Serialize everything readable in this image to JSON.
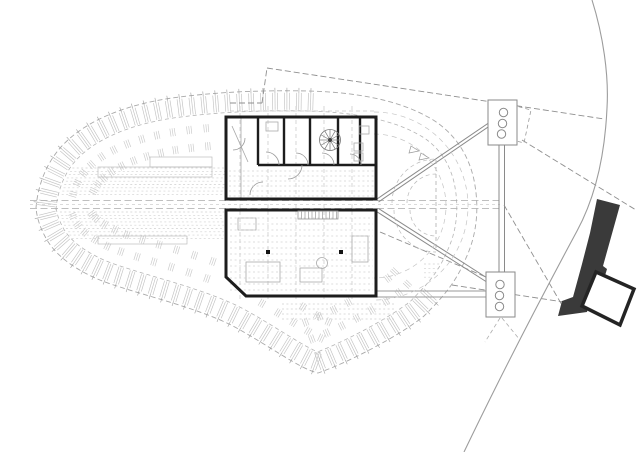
{
  "meta": {
    "kind": "architectural-site-plan",
    "visible_text": [],
    "background": "#ffffff"
  },
  "colors": {
    "faint": "#d0d0d0",
    "texture": "#c2c2c2",
    "light": "#b5b5b5",
    "boundary": "#a9a9a9",
    "medium": "#8f8f8f",
    "bridge": "#8a8a8a",
    "bold": "#1d1d1d",
    "dark_fill": "#3a3a3a",
    "platform_stroke": "#242424",
    "white": "#ffffff",
    "column": "#141414"
  },
  "stadium": {
    "outer": "M36,208 C38,183 48,158 68,140 C92,118 130,104 172,98 C215,92 262,90 308,91 C352,92 396,99 428,117 C452,130 468,152 474,180 C479,205 478,232 466,258 C456,282 444,296 424,316 C402,334 350,362 318,373 C300,369 268,345 233,326 C200,309 150,297 117,286 C90,278 60,262 47,240 C40,228 37,218 36,208 Z",
    "centroid": [
      258,
      230
    ],
    "inner_offset": 20,
    "rib_step": 12,
    "cluster_offsets": [
      34,
      52
    ],
    "cluster_step": 18,
    "strips": [
      {
        "y0": 168,
        "y1": 197,
        "step": 3.3,
        "side": "L",
        "xEnd": 226
      },
      {
        "y0": 212,
        "y1": 241,
        "step": 3.3,
        "side": "L",
        "xEnd": 224
      },
      {
        "y0": 222,
        "y1": 239,
        "step": 3.4,
        "side": "R",
        "xStart": 448
      },
      {
        "y0": 264,
        "y1": 289,
        "step": 4.4,
        "side": "R",
        "xStart": 424
      },
      {
        "y0": 304,
        "y1": 322,
        "step": 5,
        "side": "F",
        "xStart": 282,
        "xEnd": 396
      }
    ],
    "rings": [
      "M374,112 A94,94 0 0 1 468,206 A94,94 0 0 1 374,300",
      "M374,134 A72,72 0 0 1 446,206 A72,72 0 0 1 374,278"
    ]
  },
  "line_groups": [
    {
      "name": "grid-line",
      "color": "#c6c6c6",
      "w": 0.7,
      "dash": "4 3",
      "lines": [
        [
          240,
          106,
          240,
          302
        ],
        [
          268,
          106,
          268,
          302
        ],
        [
          296,
          106,
          296,
          302
        ],
        [
          324,
          106,
          324,
          302
        ],
        [
          352,
          106,
          352,
          302
        ],
        [
          230,
          111,
          375,
          111
        ]
      ]
    },
    {
      "name": "corridor-line",
      "color": "#ababab",
      "w": 0.8,
      "dash": "7 3.5",
      "lines": [
        [
          30,
          200.5,
          376,
          200.5
        ],
        [
          30,
          208.5,
          376,
          208.5
        ],
        [
          377,
          200.5,
          500,
          200.5
        ],
        [
          377,
          208.5,
          500,
          208.5
        ]
      ]
    },
    {
      "name": "corridor-centerline",
      "color": "#cfcfcf",
      "w": 0.7,
      "dash": "3 3",
      "lines": [
        [
          30,
          204.5,
          500,
          204.5
        ]
      ]
    },
    {
      "name": "walkway-line",
      "color": "#9a9a9a",
      "w": 0.9,
      "dash": "",
      "lines": [
        [
          377,
          291,
          487,
          291
        ],
        [
          377,
          297,
          487,
          297
        ]
      ]
    },
    {
      "name": "bridge-line",
      "color": "#8a8a8a",
      "w": 1,
      "dash": "",
      "lines": [
        [
          377,
          199,
          490,
          122
        ],
        [
          378.5,
          202,
          491,
          125
        ],
        [
          376.5,
          211.5,
          487.5,
          282.5
        ],
        [
          378.5,
          208.5,
          489.5,
          279.5
        ],
        [
          499,
          145,
          499,
          272
        ],
        [
          504.5,
          145,
          504.5,
          272
        ]
      ]
    },
    {
      "name": "setback-dashed-line",
      "color": "#8f8f8f",
      "w": 0.9,
      "dash": "6 3",
      "lines": [
        [
          230,
          103,
          262,
          103
        ],
        [
          262,
          103,
          267,
          68
        ],
        [
          267,
          68,
          604,
          119
        ],
        [
          522,
          140,
          636,
          210
        ],
        [
          452,
          285,
          583,
          305
        ],
        [
          504,
          205,
          566,
          312
        ],
        [
          380,
          232,
          486,
          277
        ]
      ]
    },
    {
      "name": "tower-ray",
      "color": "#adadad",
      "w": 0.8,
      "dash": "4 3",
      "lines": [
        [
          500,
          318,
          485,
          342
        ],
        [
          502,
          318,
          520,
          340
        ],
        [
          436,
          160,
          436,
          250
        ]
      ]
    },
    {
      "name": "interior-wall",
      "color": "#1d1d1d",
      "w": 2.4,
      "dash": "",
      "lines": [
        [
          258,
          118,
          258,
          165
        ],
        [
          284,
          118,
          284,
          165
        ],
        [
          310,
          118,
          310,
          165
        ],
        [
          338,
          118,
          338,
          165
        ],
        [
          360,
          118,
          360,
          165
        ],
        [
          258,
          165,
          376,
          165
        ]
      ]
    },
    {
      "name": "interior-light-line",
      "color": "#a8a8a8",
      "w": 0.8,
      "dash": "",
      "lines": [
        [
          241,
          118,
          241,
          198
        ],
        [
          232,
          126,
          248,
          162
        ]
      ]
    }
  ],
  "path_groups": [
    {
      "name": "stadium-ring-arc",
      "color": "#c4c4c4",
      "w": 0.7,
      "dash": "5 4",
      "fill": "none",
      "paths": [
        "M374,112 A94,94 0 0 1 468,206 A94,94 0 0 1 374,300",
        "M374,134 A72,72 0 0 1 446,206 A72,72 0 0 1 374,278"
      ]
    },
    {
      "name": "concourse-arc",
      "color": "#b9b9b9",
      "w": 0.7,
      "dash": "4 3",
      "fill": "none",
      "paths": [
        "M392,203 A44,44 0 0 1 436,159",
        "M407,203 A29,29 0 0 1 436,174",
        "M394,210 A42,42 0 0 0 436,252",
        "M410,210 A26,26 0 0 0 436,236"
      ]
    },
    {
      "name": "marker-triangle",
      "color": "#999999",
      "w": 0.7,
      "dash": "",
      "fill": "none",
      "paths": [
        "M411,146 L419,151 L409,153 Z",
        "M421,153 L429,158 L419,160 Z"
      ]
    },
    {
      "name": "tower-link-quad",
      "color": "#9a9a9a",
      "w": 0.8,
      "dash": "4 3",
      "fill": "none",
      "paths": [
        "M505,103 L531,110 L524,143 L498,136 Z"
      ]
    },
    {
      "name": "door-arc",
      "color": "#999999",
      "w": 0.8,
      "dash": "",
      "fill": "none",
      "paths": [
        "M266,152 A13,13 0 0 1 279,165",
        "M296,153 A12,12 0 0 1 308,165",
        "M322,153 A12,12 0 0 1 334,165",
        "M350,154 A11,11 0 0 1 361,165",
        "M288,179 A14,14 0 0 0 302,165",
        "M250,195 A13,13 0 0 1 263,182",
        "M233,150 A12,12 0 0 0 245,138"
      ]
    }
  ],
  "rect_groups": [
    {
      "name": "stand-rect",
      "color": "#bdbdbd",
      "w": 0.7,
      "rects": [
        [
          150,
          157,
          62,
          10
        ],
        [
          98,
          167,
          114,
          10
        ],
        [
          98,
          236,
          89,
          8
        ]
      ]
    },
    {
      "name": "furniture-rect",
      "color": "#ababab",
      "w": 0.8,
      "rects": [
        [
          246,
          262,
          34,
          20
        ],
        [
          300,
          268,
          22,
          14
        ],
        [
          352,
          236,
          16,
          26
        ],
        [
          266,
          122,
          12,
          9
        ],
        [
          359,
          126,
          10,
          8
        ],
        [
          354,
          143,
          9,
          8
        ],
        [
          354,
          153,
          9,
          8
        ],
        [
          238,
          218,
          18,
          12
        ]
      ]
    }
  ],
  "block_rows": [
    {
      "y0": 171,
      "y1": 196,
      "step": 5,
      "x0": 229,
      "x1": 374
    },
    {
      "y0": 218,
      "y1": 290,
      "step": 6,
      "x0": 230,
      "x1": 373
    }
  ],
  "buildings": {
    "upper_outline": "M226,117 H376 V199 H226 Z",
    "lower_outline": "M226,210 H376 V296 H246 L226,277 Z"
  },
  "stair_hatch": {
    "x": 298,
    "y": 211,
    "w": 40,
    "h": 8,
    "rung_step": 3.5,
    "color": "#9a9a9a"
  },
  "spiral_stair": {
    "cx": 330,
    "cy": 140,
    "r": 10.5,
    "spokes": 12,
    "color": "#777777"
  },
  "columns": {
    "size": 4,
    "fill": "#141414",
    "points": [
      [
        268,
        252
      ],
      [
        341,
        252
      ]
    ]
  },
  "misc_circles": [
    {
      "cx": 322,
      "cy": 263,
      "r": 5.5,
      "color": "#ababab"
    }
  ],
  "towers": {
    "stroke": "#8a8a8a",
    "w": 1,
    "fill": "#ffffff",
    "porthole_r": 4.2,
    "items": [
      {
        "x": 488,
        "y": 100,
        "w": 29,
        "h": 45,
        "circles": [
          [
            503.5,
            112.5
          ],
          [
            502.5,
            123.5
          ],
          [
            501.5,
            134
          ]
        ]
      },
      {
        "x": 486,
        "y": 272,
        "w": 29,
        "h": 45,
        "circles": [
          [
            500,
            284.5
          ],
          [
            499.5,
            295.5
          ],
          [
            499.5,
            306.5
          ]
        ]
      }
    ]
  },
  "dark_shapes": {
    "band": "M597,199 L620,205 L603,266 L607,269 L596,306 L589,304 L587,312 L558,316 L562,301 L573,297 L582,264 L590,233 Z",
    "band_fill": "#3a3a3a",
    "platform": "M596,272 L634,289 L620,325 L582,306 Z",
    "platform_stroke": "#242424",
    "platform_stroke_w": 3.5
  },
  "site_boundary": {
    "path": "M592,0 C603,35 609,75 607,108 C605,152 596,196 577,231 C556,270 513,350 464,452",
    "color": "#9c9c9c",
    "w": 1.1
  }
}
